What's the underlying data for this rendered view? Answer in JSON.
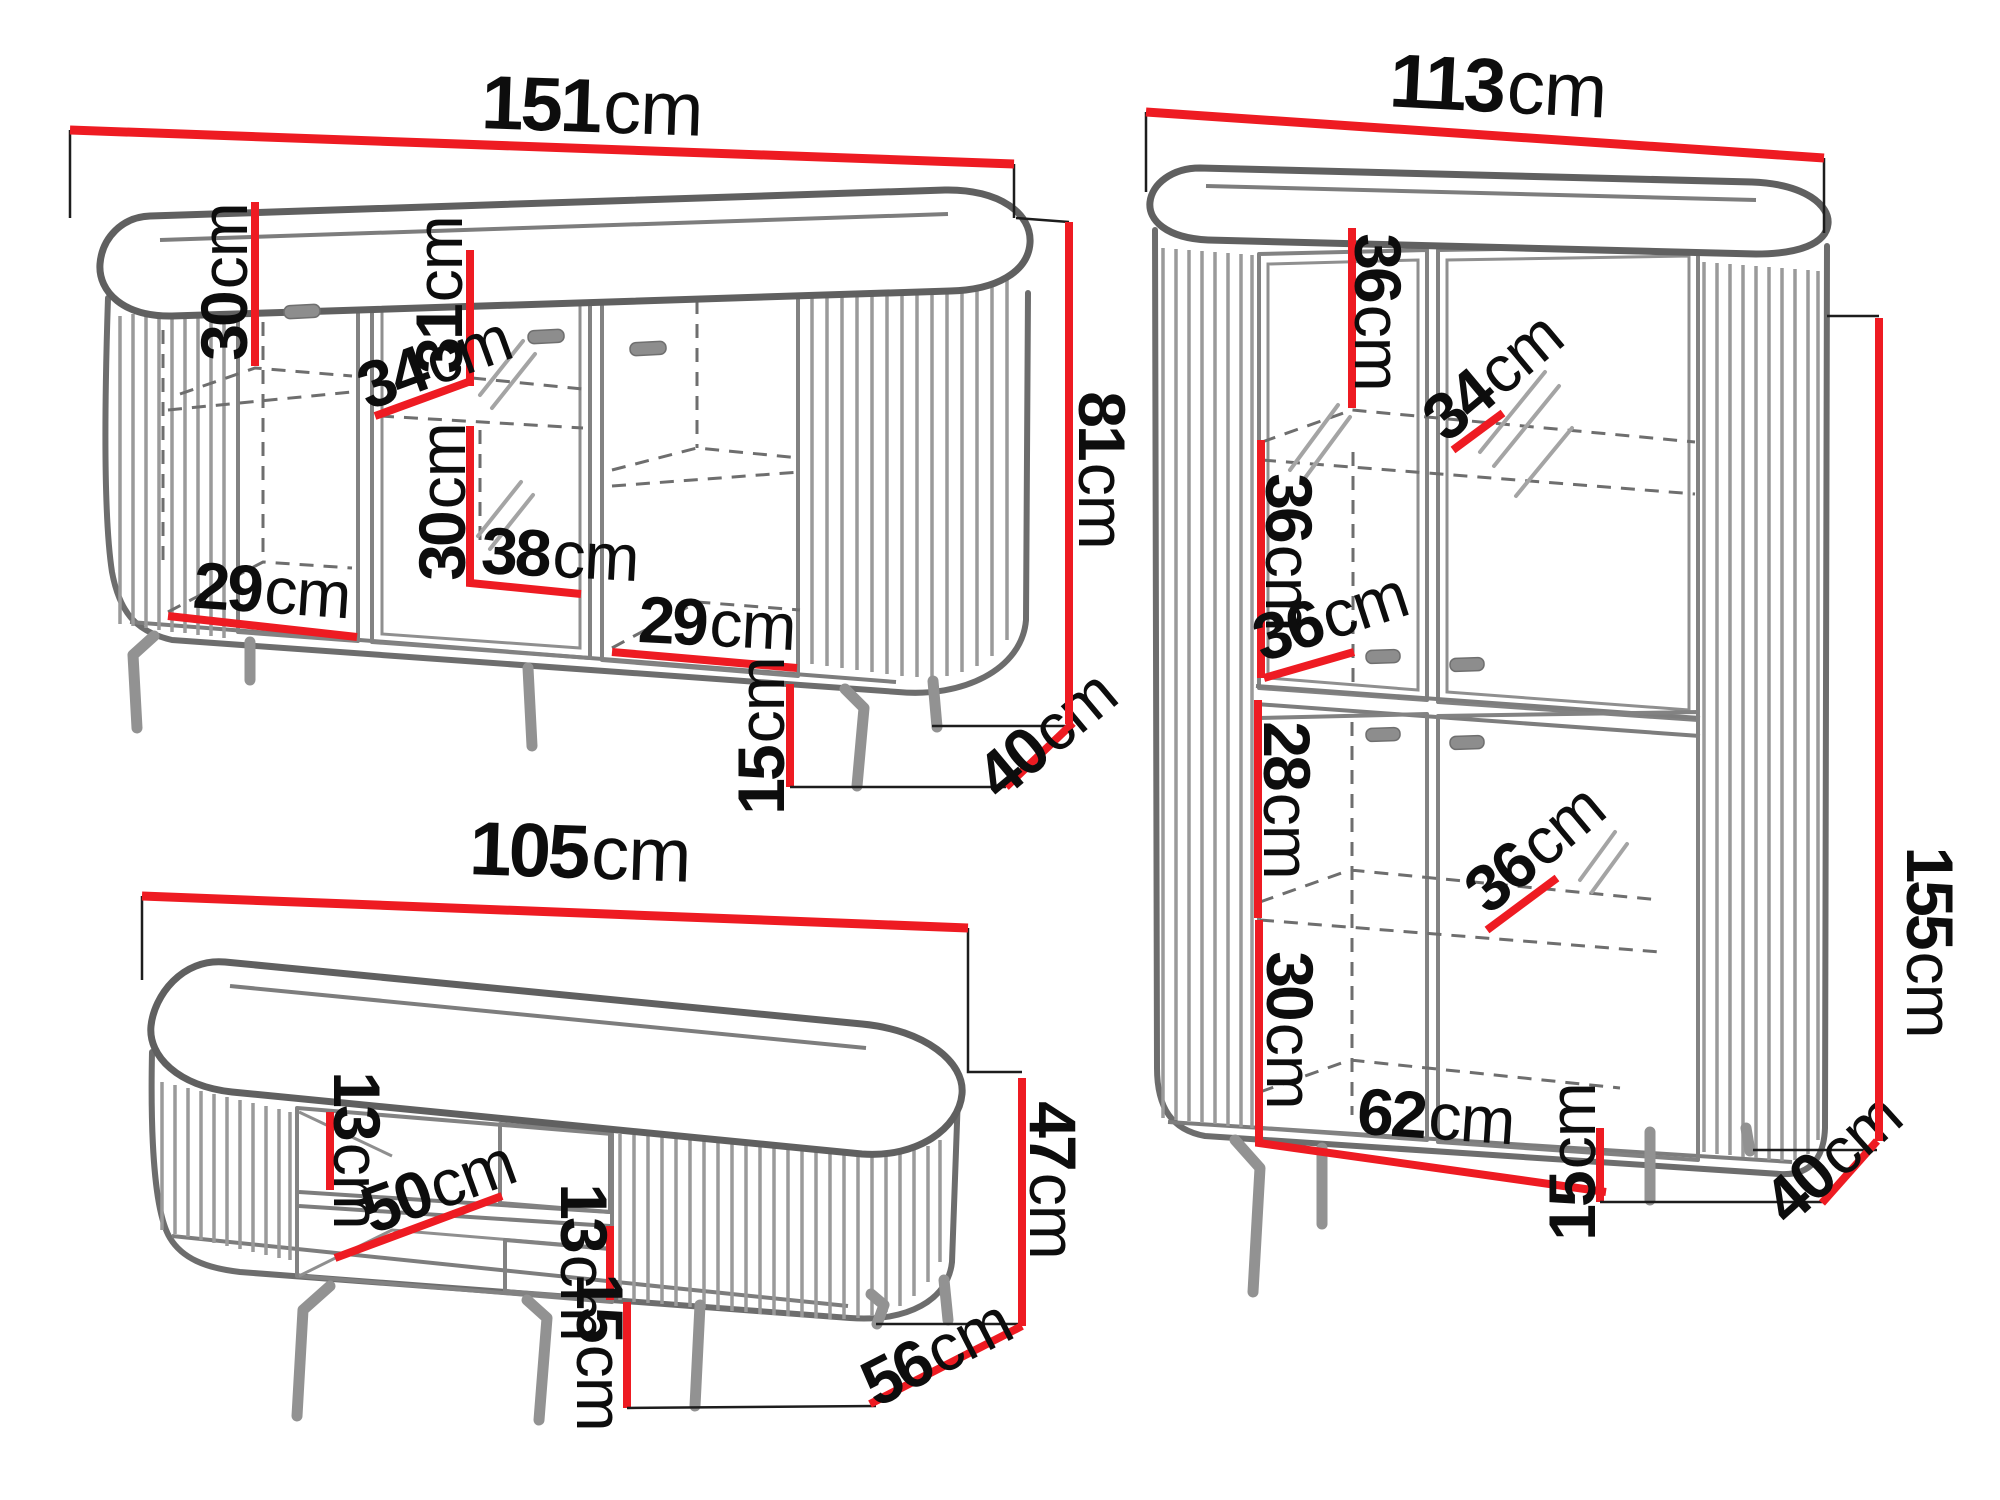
{
  "diagram_title": "Furniture set dimensions diagram",
  "unit_system": "cm",
  "colors": {
    "dimension_line": "#ee1b22",
    "outline": "#6d6d6d",
    "label": "#0d0d0d",
    "background": "#ffffff"
  },
  "pieces": [
    {
      "name": "sideboard",
      "dims": [
        {
          "id": "width",
          "value": "151",
          "unit": "cm"
        },
        {
          "id": "left-interior-height",
          "value": "30",
          "unit": "cm"
        },
        {
          "id": "middle-upper-interior-height",
          "value": "31",
          "unit": "cm"
        },
        {
          "id": "shelf-depth",
          "value": "34",
          "unit": "cm"
        },
        {
          "id": "middle-lower-interior-height",
          "value": "30",
          "unit": "cm"
        },
        {
          "id": "middle-interior-width",
          "value": "38",
          "unit": "cm"
        },
        {
          "id": "left-interior-width",
          "value": "29",
          "unit": "cm"
        },
        {
          "id": "right-interior-width",
          "value": "29",
          "unit": "cm"
        },
        {
          "id": "leg-height",
          "value": "15",
          "unit": "cm"
        },
        {
          "id": "depth",
          "value": "40",
          "unit": "cm"
        },
        {
          "id": "height",
          "value": "81",
          "unit": "cm"
        }
      ]
    },
    {
      "name": "display-cabinet",
      "dims": [
        {
          "id": "width",
          "value": "113",
          "unit": "cm"
        },
        {
          "id": "top-interior-height",
          "value": "36",
          "unit": "cm"
        },
        {
          "id": "top-shelf-depth",
          "value": "34",
          "unit": "cm"
        },
        {
          "id": "mid-interior-height",
          "value": "36",
          "unit": "cm"
        },
        {
          "id": "mid-shelf-depth",
          "value": "36",
          "unit": "cm"
        },
        {
          "id": "lower-upper-interior-height",
          "value": "28",
          "unit": "cm"
        },
        {
          "id": "lower-shelf-depth",
          "value": "36",
          "unit": "cm"
        },
        {
          "id": "lower-interior-height",
          "value": "30",
          "unit": "cm"
        },
        {
          "id": "interior-width",
          "value": "62",
          "unit": "cm"
        },
        {
          "id": "leg-height",
          "value": "15",
          "unit": "cm"
        },
        {
          "id": "depth",
          "value": "40",
          "unit": "cm"
        },
        {
          "id": "height",
          "value": "155",
          "unit": "cm"
        }
      ]
    },
    {
      "name": "tv-stand",
      "dims": [
        {
          "id": "width",
          "value": "105",
          "unit": "cm"
        },
        {
          "id": "upper-shelf-height",
          "value": "13",
          "unit": "cm"
        },
        {
          "id": "shelf-width",
          "value": "50",
          "unit": "cm"
        },
        {
          "id": "lower-shelf-height",
          "value": "13",
          "unit": "cm"
        },
        {
          "id": "leg-height",
          "value": "15",
          "unit": "cm"
        },
        {
          "id": "depth",
          "value": "56",
          "unit": "cm"
        },
        {
          "id": "height",
          "value": "47",
          "unit": "cm"
        }
      ]
    }
  ]
}
